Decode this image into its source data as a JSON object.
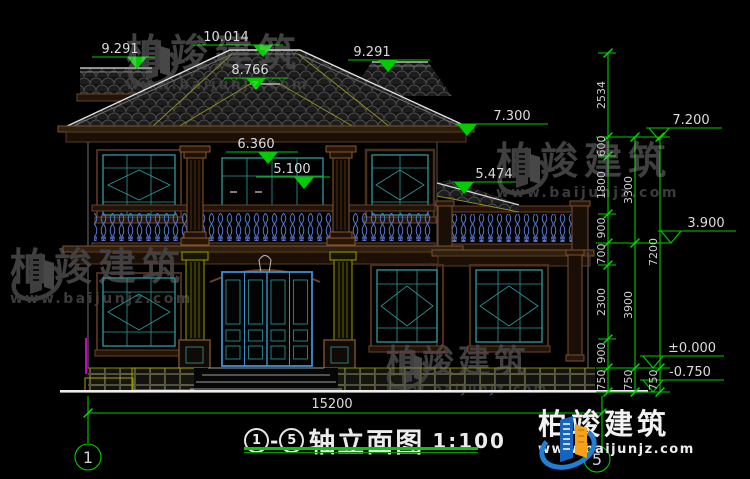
{
  "levels": {
    "ridge": "10.014",
    "roof_left": "9.291",
    "roof_right": "9.291",
    "front_ridge": "8.766",
    "eave": "7.300",
    "upper": "7.200",
    "balcony_header": "6.360",
    "balcony_rail": "5.100",
    "porch_roof": "5.474",
    "terrace": "3.900",
    "floor_zero": "±0.000",
    "ground": "-0.750"
  },
  "vdims": {
    "col1": [
      "2534",
      "600",
      "1800",
      "900",
      "700",
      "2300",
      "900",
      "750"
    ],
    "col2": [
      "3300",
      "3900",
      "750"
    ],
    "col3": [
      "7200",
      "750"
    ]
  },
  "hdim": "15200",
  "axis": {
    "left": "1",
    "right": "5"
  },
  "title": {
    "from": "1",
    "to": "5",
    "dash": "-",
    "name": "轴立面图",
    "scale": "1:100"
  },
  "watermark": {
    "brand": "柏竣建筑",
    "url": "www.baijunjz.com"
  },
  "logo": {
    "brand": "柏竣建筑",
    "url": "www.baijunjz.com"
  },
  "colors": {
    "background": "#000000",
    "dimension_green": "#00cc00",
    "dimension_text": "#dcdcdc",
    "window_teal": "#2e9b9b",
    "trim_brown": "#7a5230",
    "column_olive": "#9a9a00",
    "baluster_blue": "#5577cc",
    "door_blue": "#3f8fd0",
    "pipe_magenta": "#cc00cc",
    "watermark_gray": "#404040",
    "logo_blue": "#1e7fd4",
    "logo_orange": "#f5a21b"
  }
}
